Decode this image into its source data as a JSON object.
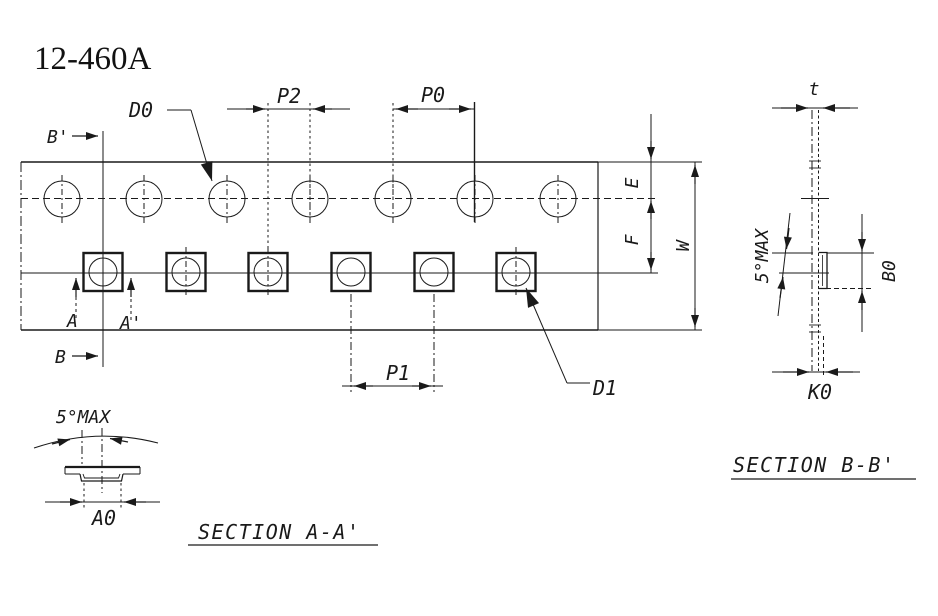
{
  "title": "12-460A",
  "plan_view": {
    "sprocket_hole_count": 7,
    "pocket_count": 6,
    "labels": {
      "p2": "P2",
      "p0": "P0",
      "p1": "P1",
      "d0": "D0",
      "d1": "D1",
      "e": "E",
      "f": "F",
      "w": "W",
      "a": "A",
      "a_prime": "A'",
      "b": "B",
      "b_prime": "B'"
    }
  },
  "section_a": {
    "caption": "SECTION A-A'",
    "angle_label": "5°MAX",
    "labels": {
      "a0": "A0"
    }
  },
  "section_b": {
    "caption": "SECTION B-B'",
    "angle_label": "5°MAX",
    "labels": {
      "t": "t",
      "b0": "B0",
      "k0": "K0"
    }
  },
  "colors": {
    "ink": "#1a1a1a",
    "background": "#ffffff"
  }
}
